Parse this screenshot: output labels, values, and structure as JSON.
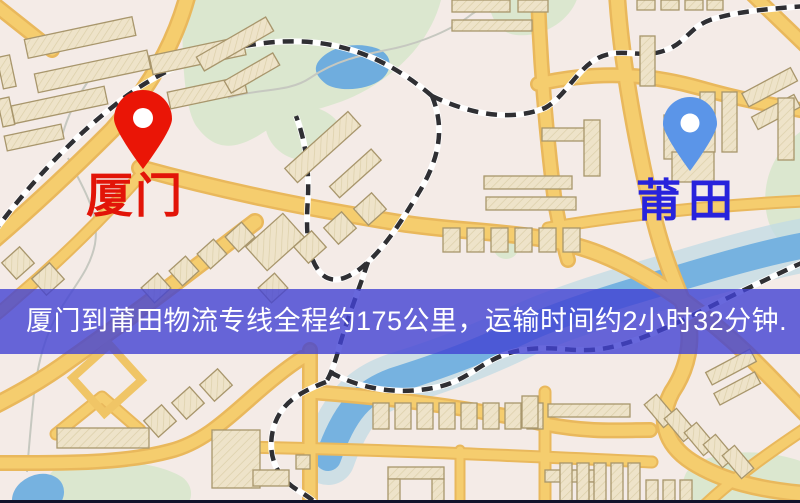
{
  "map": {
    "origin": {
      "label": "厦门",
      "pin_color": "#ea1506",
      "label_color": "#e21408"
    },
    "destination": {
      "label": "莆田",
      "pin_color": "#5b95e8",
      "label_color": "#2823dc"
    },
    "banner": {
      "text": "厦门到莆田物流专线全程约175公里，运输时间约2小时32分钟.",
      "background": "#4242d3",
      "text_color": "#ffffff"
    },
    "route": {
      "distance_text": "约175公里",
      "duration_text": "约2小时32分钟"
    },
    "legend_colors": {
      "land": "#f4ebe7",
      "park": "#dbe7cf",
      "water": "#76b2e0",
      "road": "#f5cd6e",
      "road_casing": "#e9b85c",
      "building": "#eee3c9",
      "railway": "#2f2f33"
    }
  }
}
